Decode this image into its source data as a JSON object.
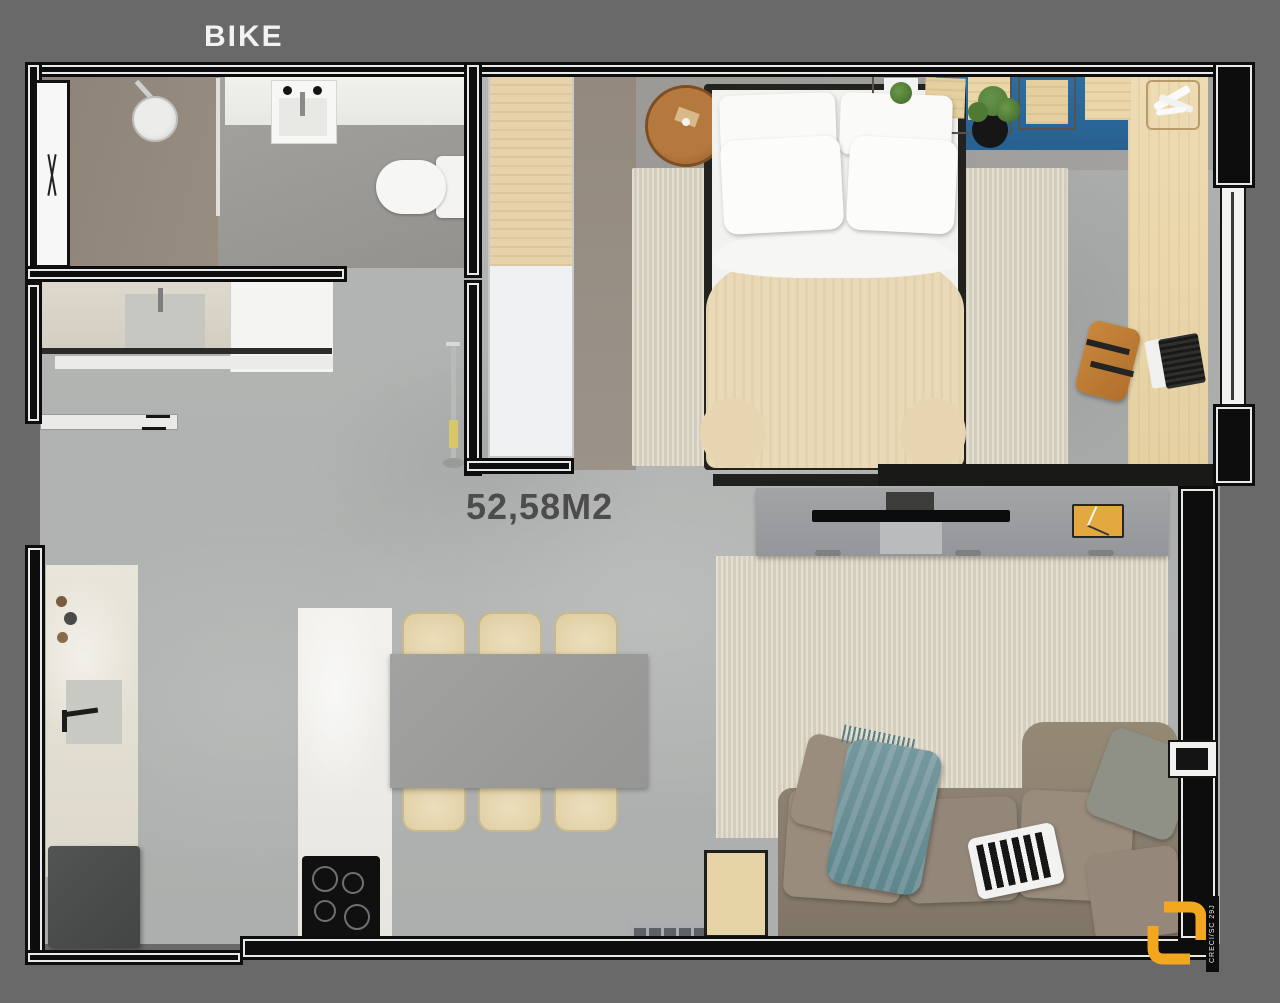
{
  "labels": {
    "bike": "BIKE",
    "area": "52,58M2"
  },
  "watermark": {
    "registration": "CRECI/SC 29J"
  },
  "palette": {
    "background": "#696969",
    "wall_black": "#0d0d0d",
    "wall_white_line": "#e9e9e9",
    "floor_concrete": "#b2b4b3",
    "floor_bedroom": "#9a9894",
    "floor_bath_shower": "#8d8378",
    "accent_blue_mat": "#2a69a2",
    "bedroom_rug": "#d7d1c1",
    "living_rug": "#dad3c2",
    "bed_blanket": "#ead9b6",
    "sofa_taupe": "#8c8172",
    "throw_teal": "#70949a",
    "wood_light": "#e8d5ac",
    "wood_chair_brown": "#c07c33",
    "dining_table_gray": "#9c9c9a",
    "tv_console_gray": "#9c9ea0",
    "fridge_dark": "#4b4d4d",
    "logo_orange": "#f2a71f",
    "decor_orange": "#e3a83e"
  }
}
